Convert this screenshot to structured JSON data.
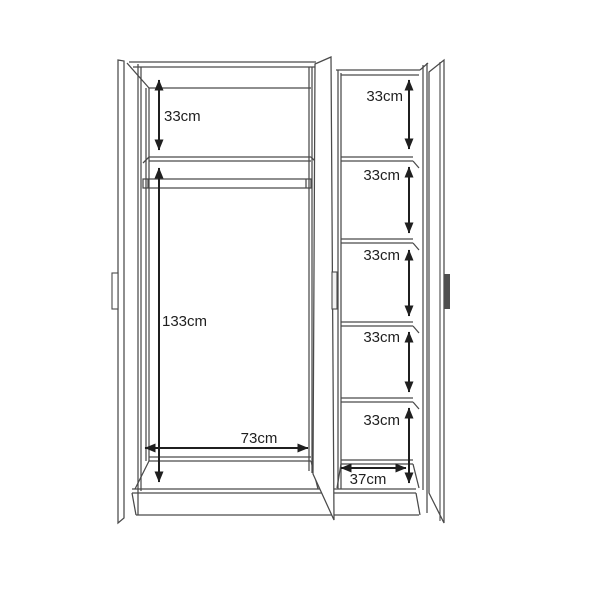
{
  "description": "Line diagram of a 3-door wardrobe interior with dimension arrows",
  "colors": {
    "background": "#ffffff",
    "furniture_line": "#4a4a4a",
    "dimension_line": "#1f1f1f",
    "right_door_handle": "#4f4f4f"
  },
  "dimensions": {
    "left_top_compartment_height": "33cm",
    "left_hanging_space_height": "133cm",
    "left_section_width": "73cm",
    "right_shelf_compartment_heights": [
      "33cm",
      "33cm",
      "33cm",
      "33cm",
      "33cm"
    ],
    "right_section_width": "37cm"
  }
}
